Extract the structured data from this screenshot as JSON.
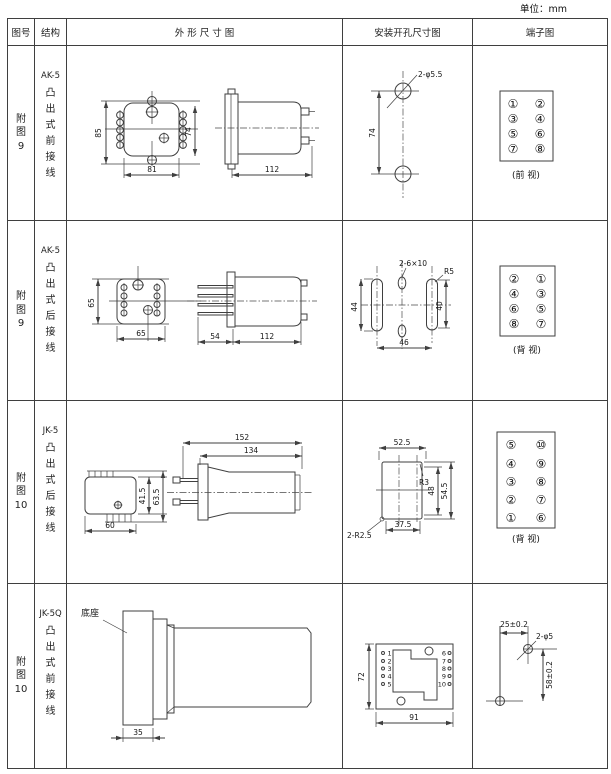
{
  "unit_label": "单位：mm",
  "header": {
    "fig_no": "图号",
    "structure": "结构",
    "outline": "外 形 尺 寸 图",
    "mounting": "安装开孔尺寸图",
    "terminal": "端子图"
  },
  "rows": [
    {
      "fig_lines": [
        "附",
        "图",
        "9"
      ],
      "model": "AK-5",
      "structure_lines": [
        "凸",
        "出",
        "式",
        "前",
        "接",
        "线"
      ],
      "outline": {
        "d1": "85",
        "d2": "74",
        "d3": "81",
        "d4": "112"
      },
      "mounting": {
        "label": "2-φ5.5",
        "d1": "74"
      },
      "terminal": {
        "c": [
          "①",
          "②",
          "③",
          "④",
          "⑤",
          "⑥",
          "⑦",
          "⑧"
        ],
        "view": "(前 视)"
      }
    },
    {
      "fig_lines": [
        "附",
        "图",
        "9"
      ],
      "model": "AK-5",
      "structure_lines": [
        "凸",
        "出",
        "式",
        "后",
        "接",
        "线"
      ],
      "outline": {
        "d1": "65",
        "d2": "65",
        "d3": "54",
        "d4": "112"
      },
      "mounting": {
        "label": "2-6×10",
        "label2": "R5",
        "d1": "44",
        "d2": "40",
        "d3": "46"
      },
      "terminal": {
        "c": [
          "②",
          "①",
          "④",
          "③",
          "⑥",
          "⑤",
          "⑧",
          "⑦"
        ],
        "view": "(背 视)"
      }
    },
    {
      "fig_lines": [
        "附",
        "图",
        "10"
      ],
      "model": "JK-5",
      "structure_lines": [
        "凸",
        "出",
        "式",
        "后",
        "接",
        "线"
      ],
      "outline": {
        "d1": "152",
        "d2": "134",
        "d3": "41.5",
        "d4": "63.5",
        "d5": "60"
      },
      "mounting": {
        "d1": "52.5",
        "label": "R3",
        "d2": "48",
        "d3": "54.5",
        "d4": "37.5",
        "label2": "2-R2.5"
      },
      "terminal": {
        "c": [
          "⑤",
          "⑩",
          "④",
          "⑨",
          "③",
          "⑧",
          "②",
          "⑦",
          "①",
          "⑥"
        ],
        "view": "(背 视)"
      }
    },
    {
      "fig_lines": [
        "附",
        "图",
        "10"
      ],
      "model": "JK-5Q",
      "structure_lines": [
        "凸",
        "出",
        "式",
        "前",
        "接",
        "线"
      ],
      "outline": {
        "label": "底座",
        "d1": "35"
      },
      "mounting": {
        "d1": "72",
        "d2": "91",
        "left": [
          "1",
          "2",
          "3",
          "4",
          "5"
        ],
        "right": [
          "6",
          "7",
          "8",
          "9",
          "10"
        ]
      },
      "terminal": {
        "d1": "25±0.2",
        "label": "2-φ5",
        "d2": "58±0.2"
      }
    }
  ]
}
